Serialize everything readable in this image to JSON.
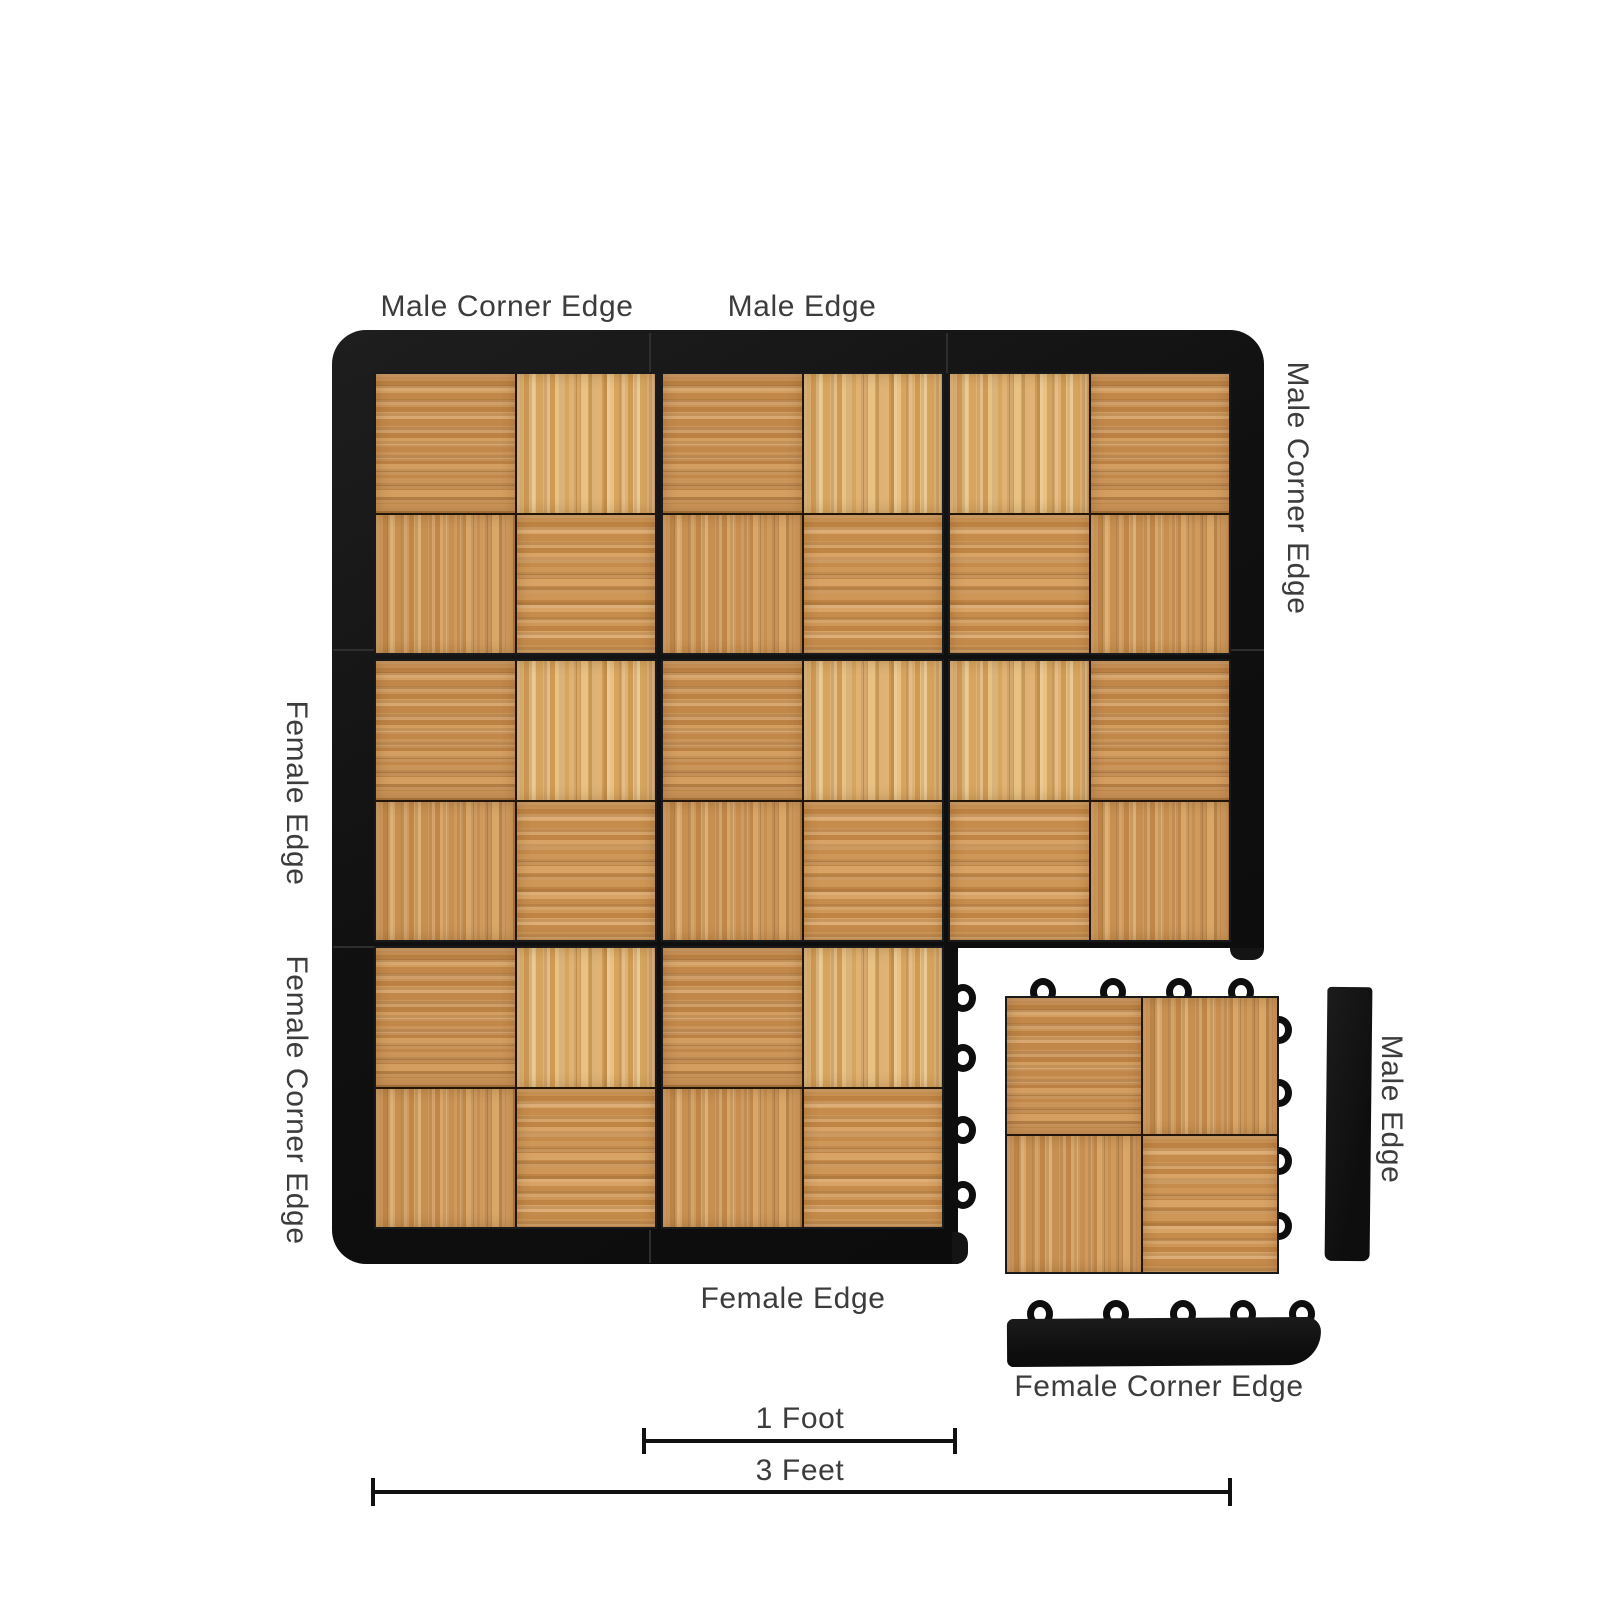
{
  "labels": {
    "floor_top_corner": "Male Corner Edge",
    "floor_top_edge": "Male Edge",
    "floor_right_corner": "Male Corner Edge",
    "floor_left_edge": "Female Edge",
    "floor_left_corner": "Female Corner Edge",
    "floor_bottom_edge": "Female Edge",
    "loose_male_edge": "Male Edge",
    "loose_female_corner": "Female Corner Edge"
  },
  "measurements": {
    "one_foot": "1 Foot",
    "three_feet": "3 Feet"
  },
  "colors": {
    "background": "#ffffff",
    "trim_black": "#141414",
    "label_text": "#3c3c3c",
    "wood_medium": "#c68d50",
    "wood_light": "#ddab68"
  },
  "floor": {
    "rows": 3,
    "cols": 3,
    "installed_tiles": 8,
    "loose_tiles": 1,
    "tile_edge_loops": 4,
    "corner_piece_loops": 5
  }
}
